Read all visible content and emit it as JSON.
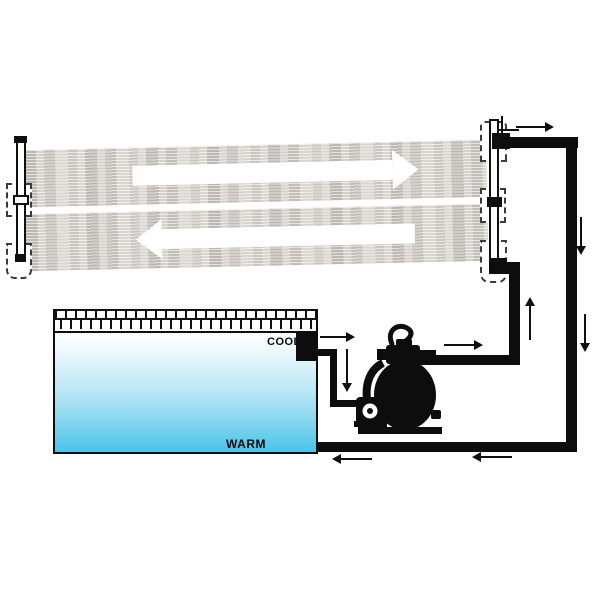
{
  "diagram": {
    "kind": "solar-pool-heating-schematic",
    "labels": {
      "cool": "COOL",
      "warm": "WARM"
    },
    "colors": {
      "pipe": "#0d0d0d",
      "outline": "#111111",
      "panel_base": "#d9d5cf",
      "panel_streak": "#b9b2a9",
      "panel_flow_arrow": "#ffffff",
      "pool_top": "#ffffff",
      "pool_bottom": "#49c4ea",
      "pump_silhouette": "#0d0d0d"
    },
    "panel_flow": {
      "top_band": "right",
      "bottom_band": "left"
    },
    "flow_arrows": [
      {
        "name": "panel-top-outlet",
        "dir": "right",
        "x": 516,
        "y": 122,
        "len": 38
      },
      {
        "name": "return-riser-upper",
        "dir": "down",
        "x": 576,
        "y": 217,
        "len": 38
      },
      {
        "name": "return-riser-lower",
        "dir": "down",
        "x": 580,
        "y": 314,
        "len": 38
      },
      {
        "name": "return-bottom-right",
        "dir": "left",
        "x": 472,
        "y": 452,
        "len": 40
      },
      {
        "name": "return-bottom-left",
        "dir": "left",
        "x": 332,
        "y": 454,
        "len": 40
      },
      {
        "name": "cool-outlet-flow",
        "dir": "right",
        "x": 320,
        "y": 332,
        "len": 35
      },
      {
        "name": "suction-drop",
        "dir": "down",
        "x": 342,
        "y": 349,
        "len": 43
      },
      {
        "name": "pump-discharge",
        "dir": "right",
        "x": 444,
        "y": 340,
        "len": 39
      },
      {
        "name": "supply-riser",
        "dir": "up",
        "x": 525,
        "y": 297,
        "len": 43
      }
    ]
  }
}
